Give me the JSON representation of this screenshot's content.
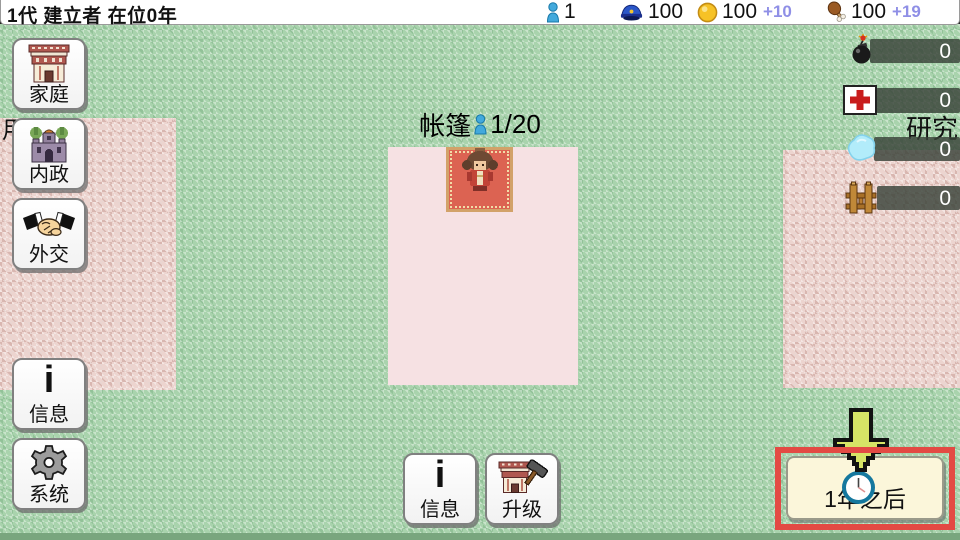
{
  "header": {
    "title": "1代 建立者 在位0年",
    "resources": {
      "population": "1",
      "soldiers": "100",
      "gold": "100",
      "gold_delta": "+10",
      "food": "100",
      "food_delta": "+19"
    }
  },
  "menu": {
    "family": "家庭",
    "internal": "内政",
    "diplomacy": "外交",
    "info": "信息",
    "system": "系统"
  },
  "map": {
    "left_label": "用地",
    "right_label": "研究",
    "tent_title": "帐篷",
    "tent_capacity": "1/20"
  },
  "research": {
    "rows": [
      {
        "name": "bomb",
        "value": "0"
      },
      {
        "name": "medical",
        "value": "0"
      },
      {
        "name": "water",
        "value": "0"
      },
      {
        "name": "wood",
        "value": "0"
      }
    ]
  },
  "actions": {
    "info": "信息",
    "info_icon_glyph": "i",
    "upgrade": "升级",
    "next_year": "1年之后"
  },
  "colors": {
    "delta": "#8f8fe6",
    "highlight": "#e34a44",
    "arrow": "#d6e466"
  }
}
